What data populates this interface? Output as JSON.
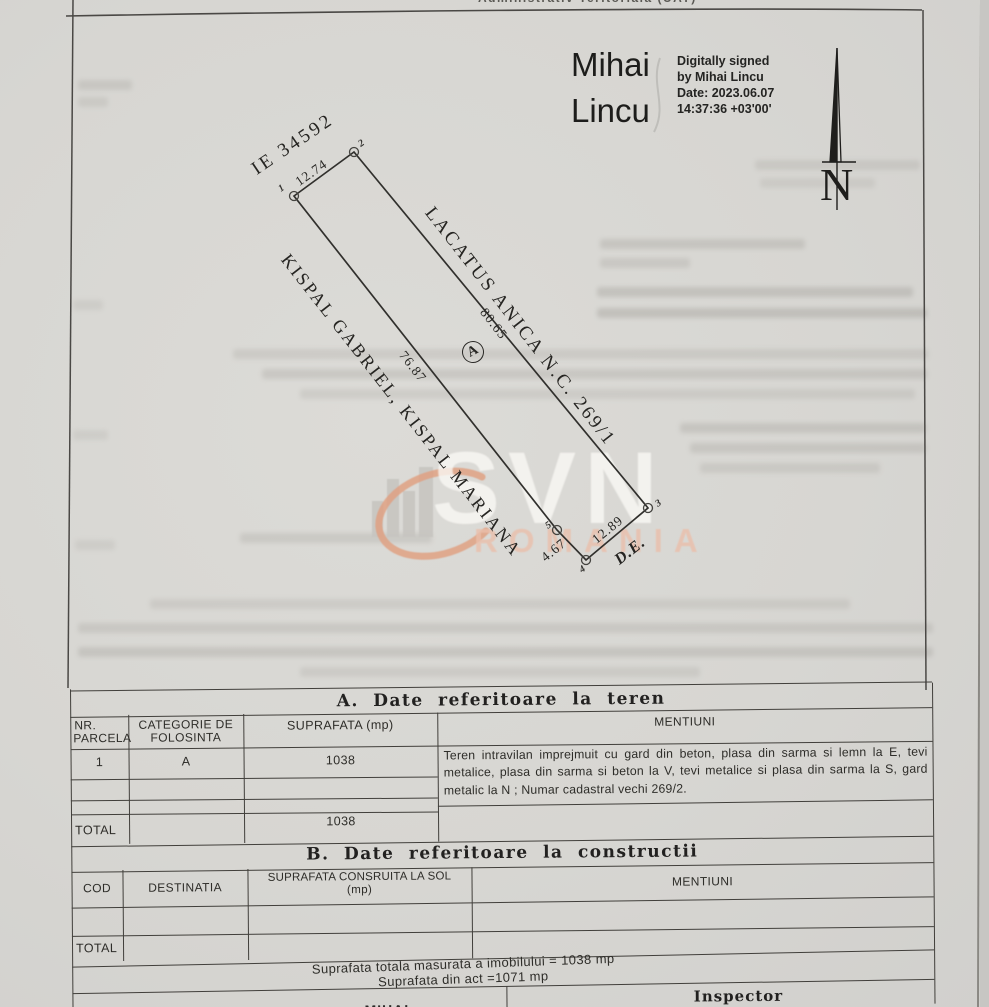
{
  "header": {
    "clipped_top_line": "Administrativ  Teritoriala  (UAT)",
    "signature": {
      "name_lines": [
        "Mihai",
        "Lincu"
      ],
      "detail_lines": [
        "Digitally signed",
        "by Mihai Lincu",
        "Date: 2023.06.07",
        "14:37:36 +03'00'"
      ]
    },
    "compass_label": "N"
  },
  "plan": {
    "parcel_id": "IE 34592",
    "parcel_letter": "A",
    "dimensions": {
      "top": "12.74",
      "right": "80.65",
      "left": "76.87",
      "bottom": "12.89",
      "bottom_short": "4.67"
    },
    "corner_labels": {
      "c1": "1",
      "c2": "2",
      "c3": "3",
      "c4": "4",
      "c5": "5"
    },
    "neighbor_east": "LACATUS ANICA N.C. 269/1",
    "neighbor_west": "KISPAL GABRIEL, KISPAL MARIANA",
    "road": "D.E."
  },
  "watermark": {
    "brand": "SVN",
    "region": "ROMANIA"
  },
  "section_a": {
    "title": "A. Date referitoare la teren",
    "col_headers": {
      "c1a": "NR.",
      "c1b": "PARCELA",
      "c2a": "CATEGORIE DE",
      "c2b": "FOLOSINTA",
      "c3": "SUPRAFATA (mp)",
      "c4": "MENTIUNI"
    },
    "row1": {
      "nr": "1",
      "categorie": "A",
      "suprafata": "1038"
    },
    "mentiuni": "Teren intravilan imprejmuit cu gard din beton, plasa din sarma si lemn la E, tevi metalice, plasa din sarma si beton la V, tevi metalice si plasa din sarma la S, gard metalic la N ; Numar cadastral vechi 269/2.",
    "total_label": "TOTAL",
    "total_suprafata": "1038"
  },
  "section_b": {
    "title": "B. Date referitoare la constructii",
    "col_headers": {
      "c1": "COD",
      "c2": "DESTINATIA",
      "c3a": "SUPRAFATA CONSRUITA LA SOL",
      "c3b": "(mp)",
      "c4": "MENTIUNI"
    },
    "total_label": "TOTAL"
  },
  "footer": {
    "measured_total": "Suprafata totala masurata a imobilului = 1038 mp",
    "act_area": "Suprafata din act =1071 mp",
    "inspector_label": "Inspector",
    "clipped_name": "MIHAI"
  },
  "colors": {
    "paper": "#d7d6d2",
    "ink": "#2c2b28",
    "line": "#413f3b",
    "watermark_swoosh": "#dfa183",
    "watermark_romania": "#eabfab"
  }
}
